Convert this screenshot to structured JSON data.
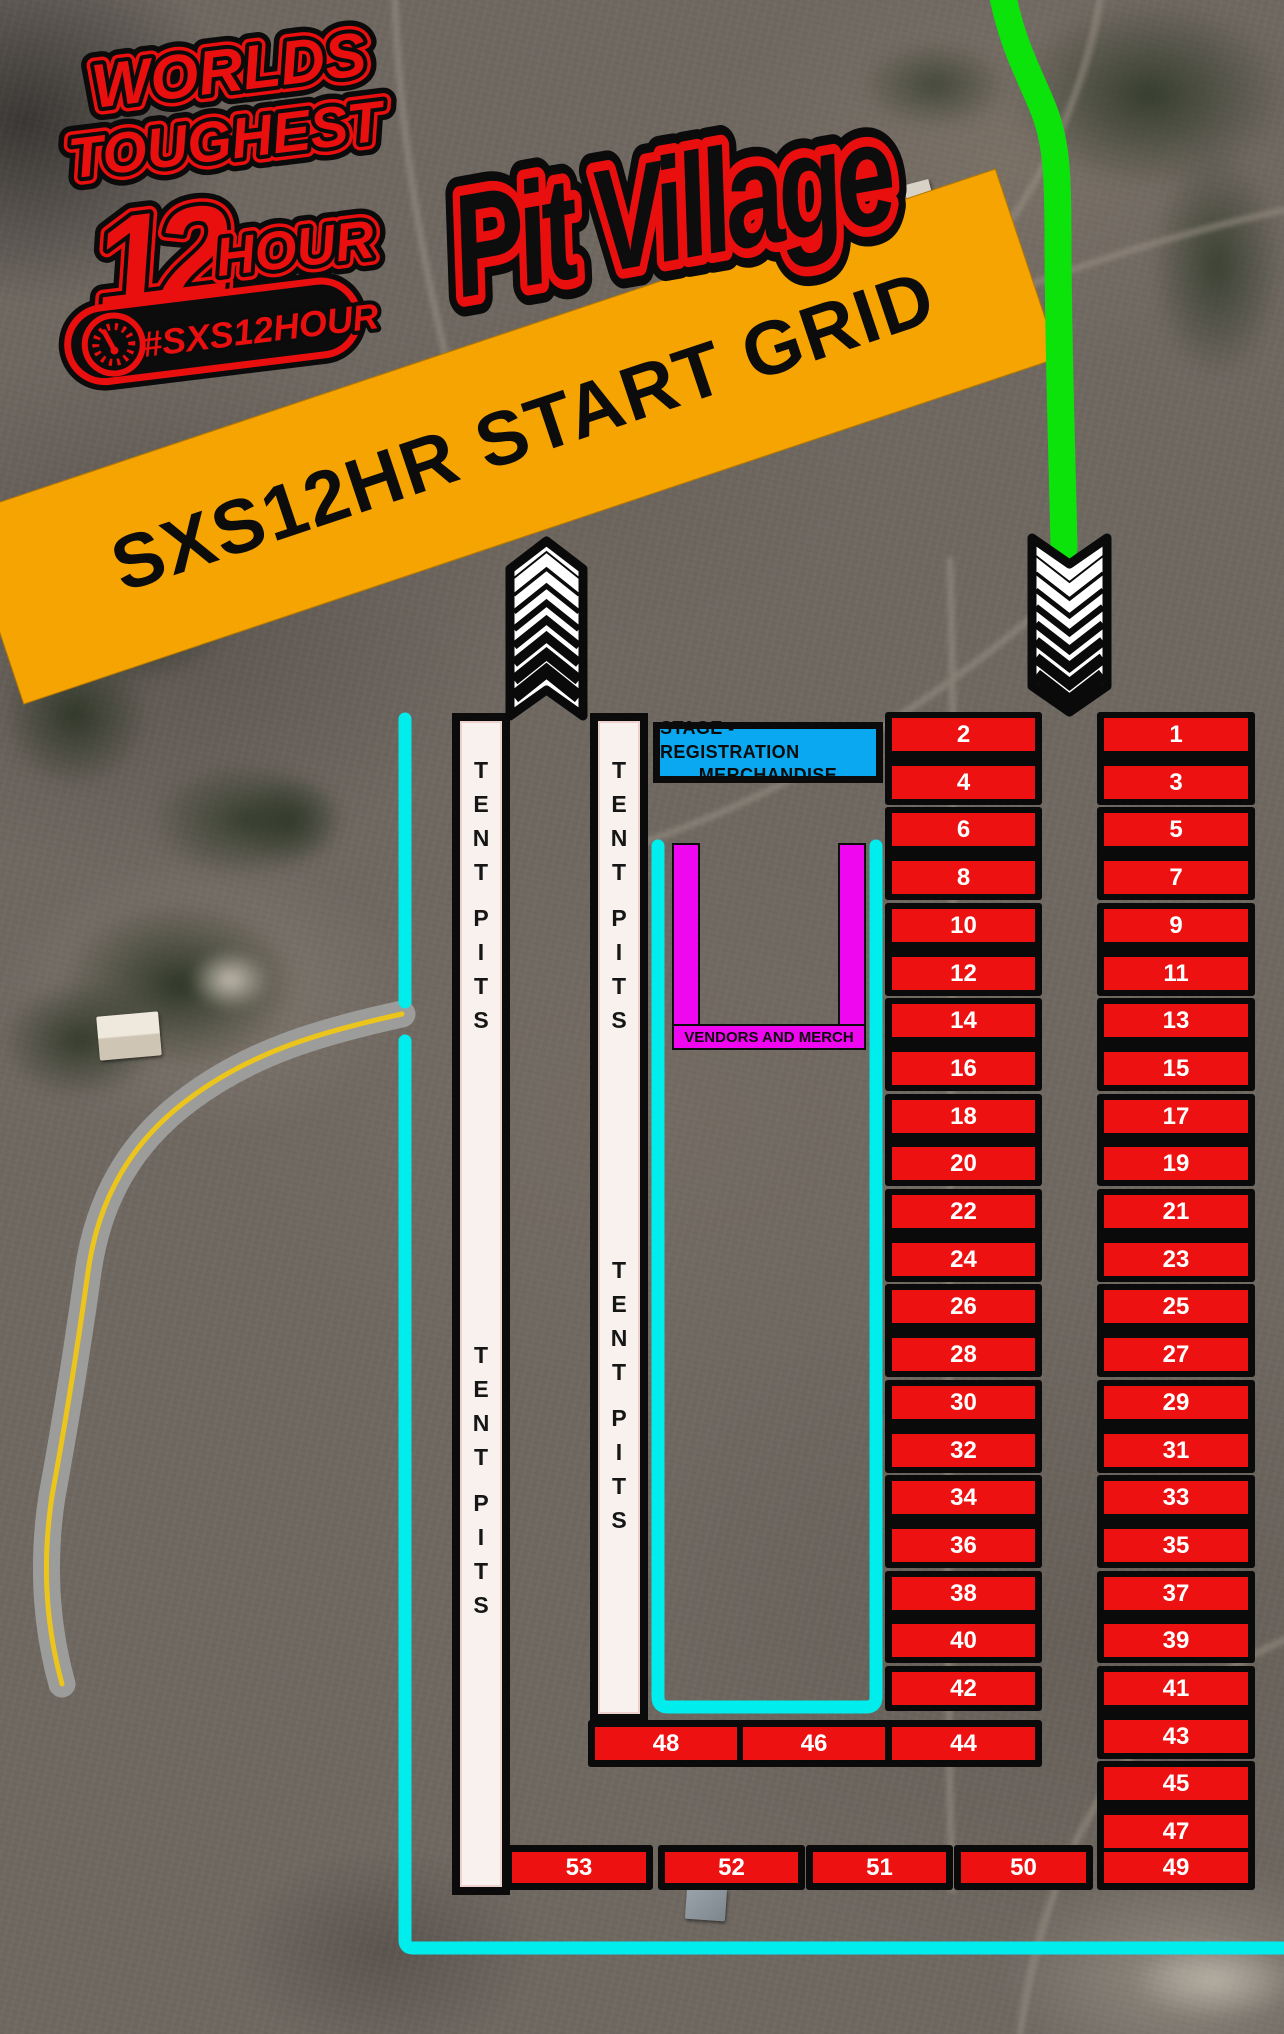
{
  "event_logo": {
    "line1": "WORLDS",
    "line2": "TOUGHEST",
    "line3_number": "12",
    "line3_word": "HOUR",
    "hashtag": "#SXS12HOUR"
  },
  "page_title": "Pit Village",
  "start_grid_banner": {
    "text": "SXS12HR START GRID"
  },
  "stage_box": {
    "line1": "STAGE - REGISTRATION",
    "line2": "MERCHANDISE"
  },
  "vendors_area": {
    "label": "VENDORS AND MERCH"
  },
  "tent_strips": {
    "left": [
      "TENT",
      "PITS",
      "TENT",
      "PITS"
    ],
    "right": [
      "TENT",
      "PITS",
      "TENT",
      "PITS"
    ]
  },
  "pit_stalls": {
    "center_column": [
      "2",
      "4",
      "6",
      "8",
      "10",
      "12",
      "14",
      "16",
      "18",
      "20",
      "22",
      "24",
      "26",
      "28",
      "30",
      "32",
      "34",
      "36",
      "38",
      "40",
      "42"
    ],
    "right_column": [
      "1",
      "3",
      "5",
      "7",
      "9",
      "11",
      "13",
      "15",
      "17",
      "19",
      "21",
      "23",
      "25",
      "27",
      "29",
      "31",
      "33",
      "35",
      "37",
      "39",
      "41",
      "43",
      "45",
      "47"
    ],
    "attached_bottom_row": [
      "48",
      "46",
      "44"
    ],
    "bottom_row": [
      "53",
      "52",
      "51",
      "50"
    ],
    "bottom_right_stall": "49"
  },
  "arrows": {
    "pit_exit_direction": "up",
    "pit_entry_direction": "down"
  },
  "colors": {
    "banner_orange": "#F6A401",
    "stall_red": "#EE1111",
    "stage_blue": "#09A8F0",
    "vendor_magenta": "#EE07EF",
    "lane_cyan": "#00EDED",
    "track_green": "#0BE30B",
    "logo_red": "#E90F0F"
  }
}
